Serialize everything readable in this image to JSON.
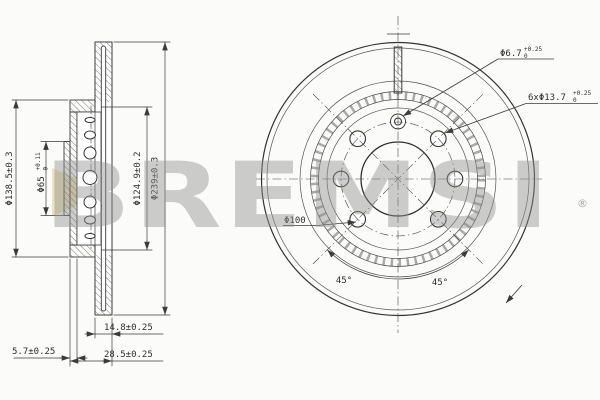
{
  "watermark": {
    "text": "BREMSI",
    "reg": "®"
  },
  "colors": {
    "line": "#3b3b3b",
    "dim_text": "#2e2e2e",
    "watermark_gray": "#919191",
    "logo_yellow": "#e9dcab",
    "background": "#fbfbfa"
  },
  "left_view": {
    "dim_hat_od": "Φ138.5±0.3",
    "dim_bore": {
      "main": "Φ65",
      "tol_up": "+0.11",
      "tol_dn": "0"
    },
    "dim_hat_cyl": "Φ124.9±0.2",
    "dim_outer": "Φ239±0.3",
    "dim_band_width": "14.8±0.25",
    "dim_total_width": "28.5±0.25",
    "dim_hat_thickness": "5.7±0.25"
  },
  "right_view": {
    "dim_pin_hole": {
      "main": "Φ6.7",
      "tol_up": "+0.25",
      "tol_dn": "0"
    },
    "dim_bolt_holes": {
      "main": "6xΦ13.7",
      "tol_up": "+0.25",
      "tol_dn": "0"
    },
    "dim_pcd": "Φ100",
    "angle_left": "45°",
    "angle_right": "45°"
  }
}
